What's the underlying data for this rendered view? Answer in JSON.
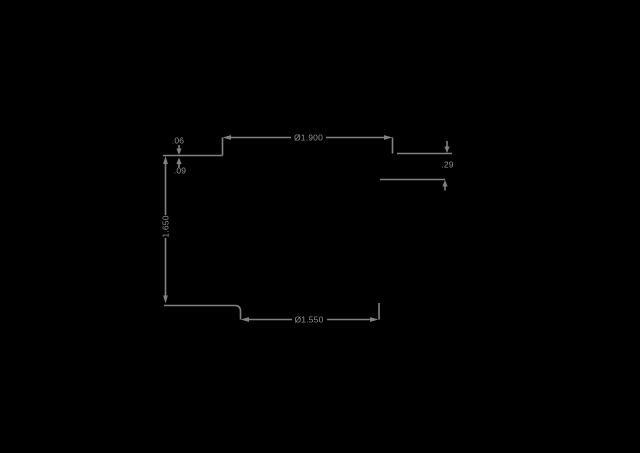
{
  "canvas": {
    "background_color": "#000000",
    "line_color": "#828282",
    "text_color": "#929292",
    "content": "technical-drawing-dimension-annotations"
  },
  "dimensions": {
    "top": {
      "label": "Ø1.900",
      "orientation": "horizontal"
    },
    "left_height": {
      "label": "1.650",
      "orientation": "vertical"
    },
    "left_step_upper": {
      "label": ".06",
      "orientation": "vertical-small"
    },
    "left_step_lower": {
      "label": ".09",
      "orientation": "vertical-small"
    },
    "right_step": {
      "label": ".29",
      "orientation": "vertical-small"
    },
    "bottom": {
      "label": "Ø1.550",
      "orientation": "horizontal"
    }
  }
}
